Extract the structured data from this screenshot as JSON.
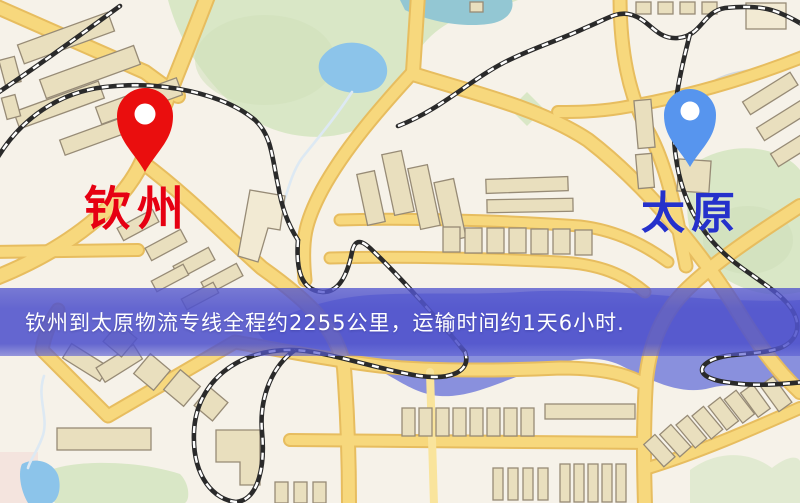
{
  "banner": {
    "text": "钦州到太原物流专线全程约2255公里，运输时间约1天6小时."
  },
  "markers": {
    "origin": {
      "name": "钦州",
      "pin_color": "#ea0e0e",
      "label_color": "#e60012"
    },
    "destination": {
      "name": "太原",
      "pin_color": "#5795ee",
      "label_color": "#2531cb"
    }
  },
  "map_colors": {
    "background": "#f6f2e9",
    "road": "#f7d87d",
    "road_casing": "#e7bd5f",
    "park": "#d9e7c6",
    "park_dark": "#cfe0ba",
    "water": "#8cc4ea",
    "water_band": "#7f88db",
    "building": "#e9dfbe",
    "building_outline": "#978b76",
    "railway": "#2a2a2a",
    "banner_bg": "#5053cc"
  }
}
